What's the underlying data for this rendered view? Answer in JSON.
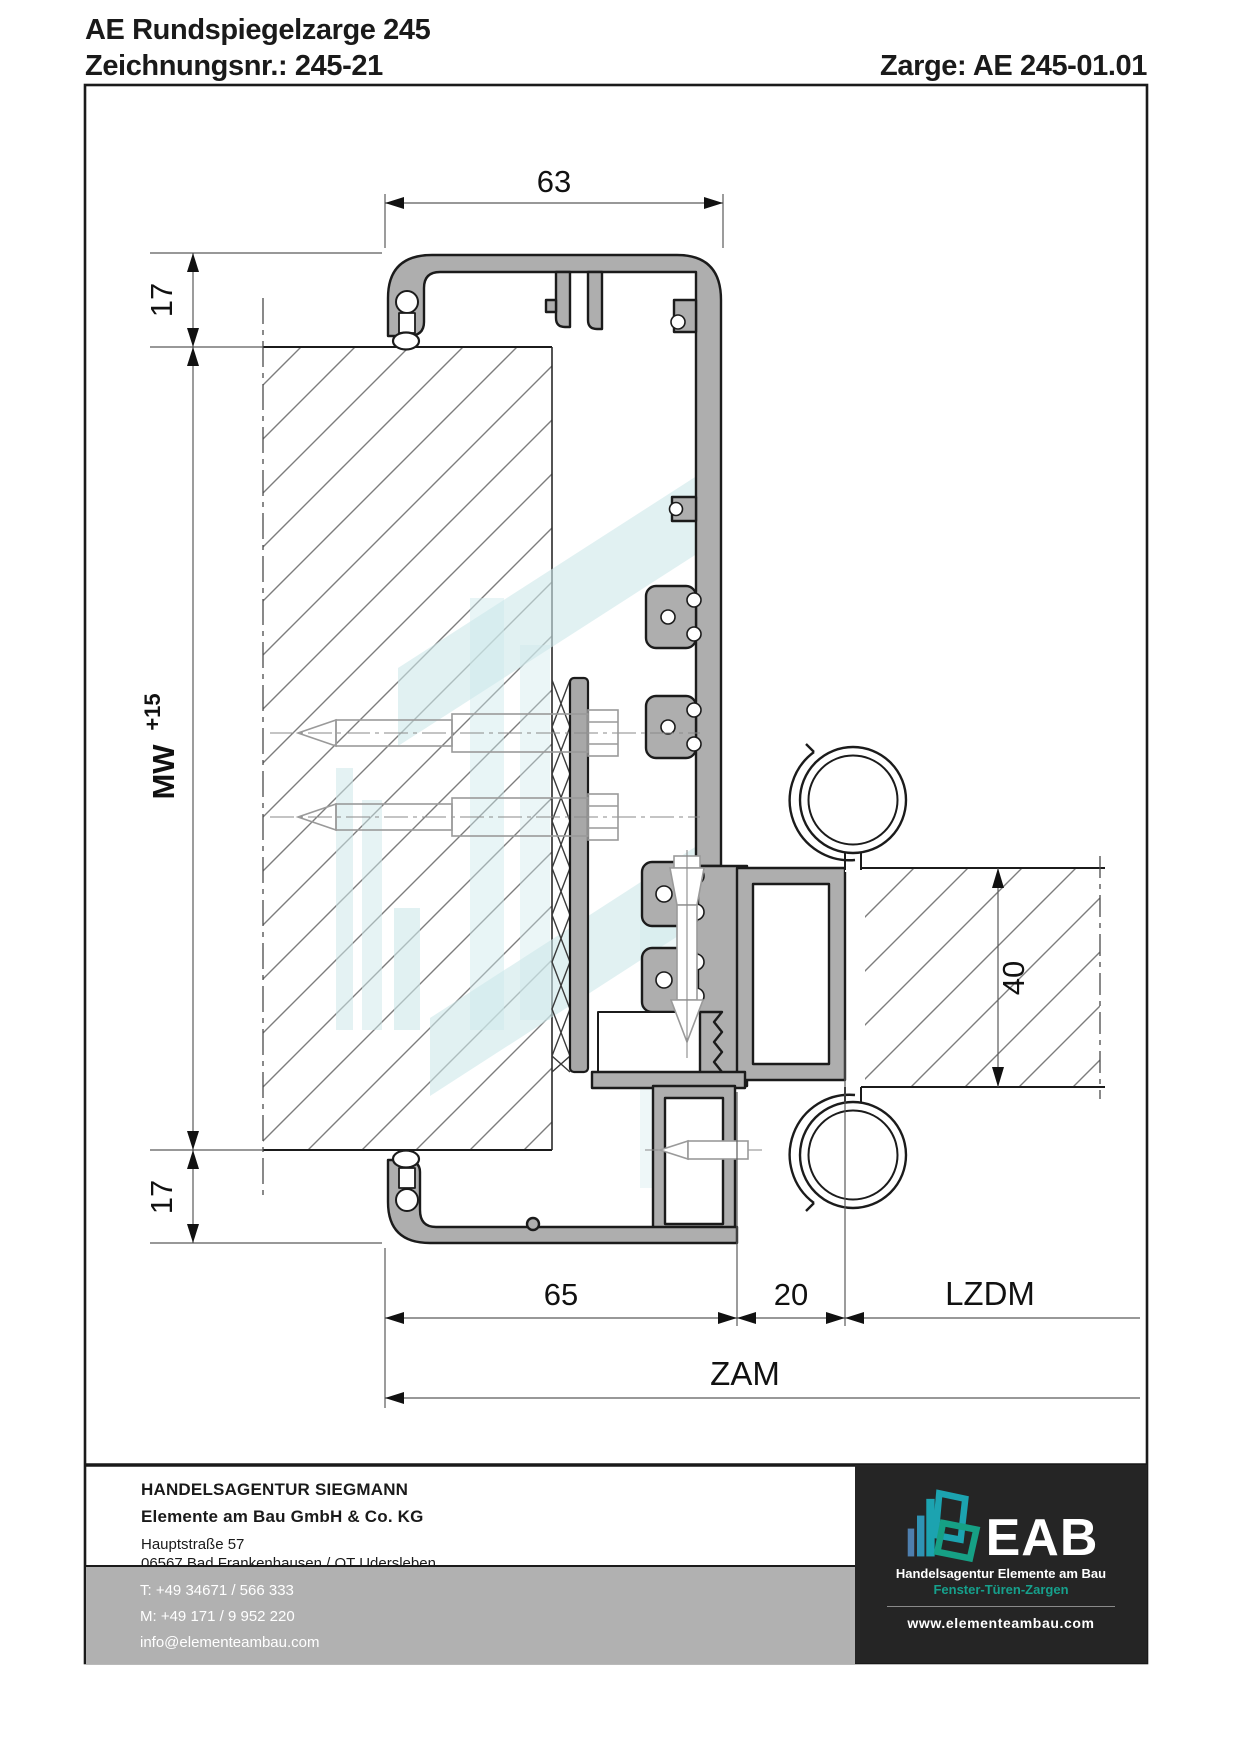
{
  "header": {
    "title": "AE Rundspiegelzarge 245",
    "drawing_no_label": "Zeichnungsnr.: 245-21",
    "zarge_label": "Zarge: AE 245-01.01"
  },
  "dims": {
    "top_width": "63",
    "top_inset": "17",
    "mirror_width": "MW",
    "mirror_width_tol": "+15",
    "bottom_inset": "17",
    "partition": "40",
    "frame_depth": "65",
    "air_gap": "20",
    "lzdm": "LZDM",
    "zam": "ZAM"
  },
  "footer": {
    "agency": "HANDELSAGENTUR SIEGMANN",
    "company": "Elemente am Bau GmbH & Co. KG",
    "street": "Hauptstraße 57",
    "city": "06567 Bad Frankenhausen / OT Udersleben",
    "phone": "T: +49 34671 / 566 333",
    "mobile": "M: +49 171 / 9 952 220",
    "email": "info@elementeambau.com"
  },
  "logo": {
    "abbr": "EAB",
    "subtitle": "Handelsagentur Elemente am Bau",
    "tagline": "Fenster-Türen-Zargen",
    "website": "www.elementeambau.com"
  },
  "colors": {
    "profile_gray": "#aeaeae",
    "outline": "#1b1b1b",
    "watermark_teal": "#cde8ea",
    "band_gray": "#b1b1b1",
    "logo_bg": "#252525",
    "accent_teal": "#16a08c"
  }
}
